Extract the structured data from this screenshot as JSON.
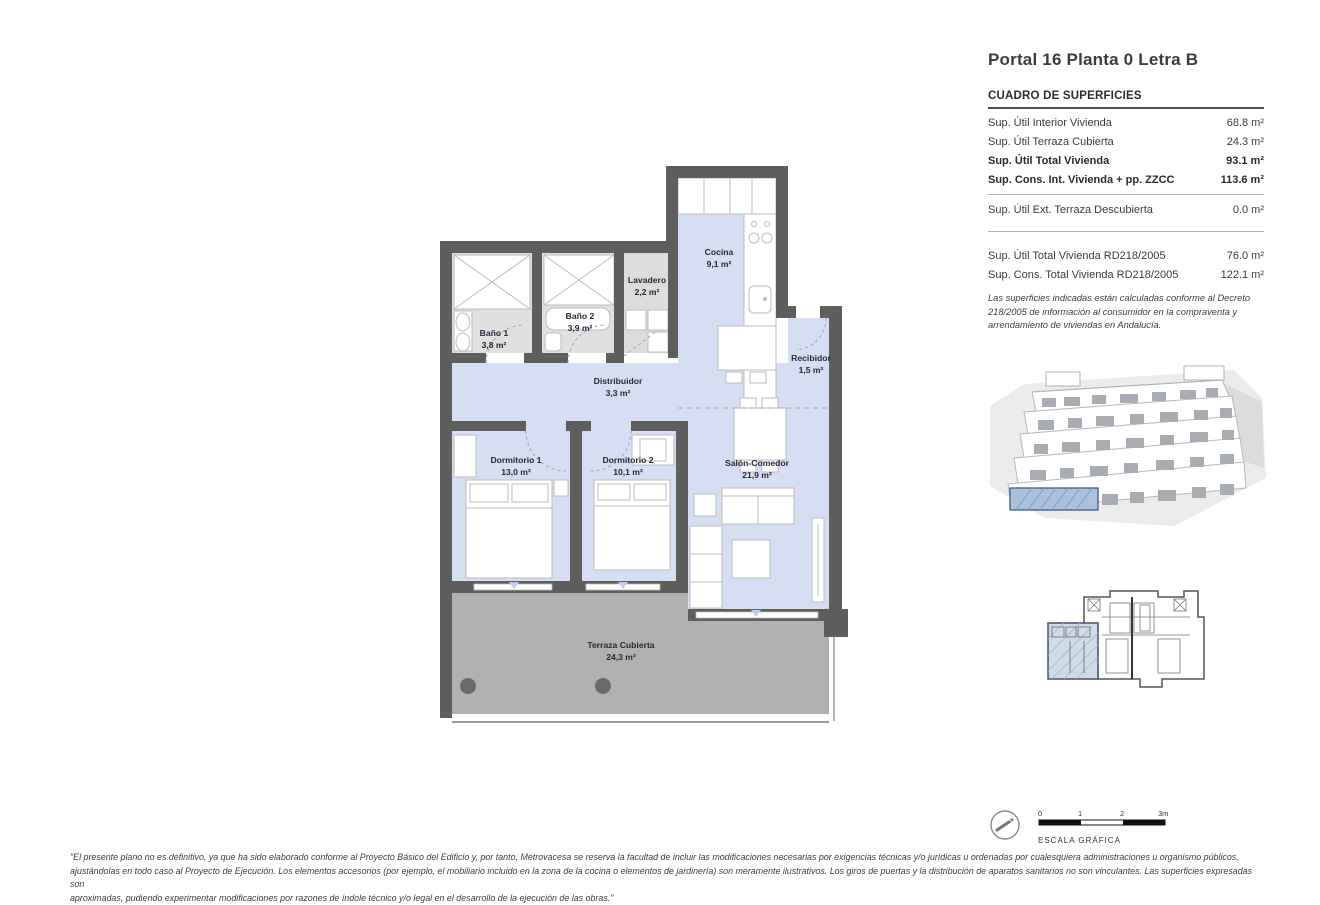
{
  "title": "Portal 16 Planta 0 Letra B",
  "surfaces": {
    "header": "CUADRO DE SUPERFICIES",
    "rows": [
      {
        "label": "Sup. Útil Interior Vivienda",
        "value": "68.8 m²"
      },
      {
        "label": "Sup. Útil Terraza Cubierta",
        "value": "24.3 m²"
      },
      {
        "label": "Sup. Útil Total Vivienda",
        "value": "93.1 m²"
      },
      {
        "label": "Sup. Cons. Int. Vivienda + pp. ZZCC",
        "value": "113.6 m²"
      },
      {
        "label": "Sup. Útil Ext. Terraza Descubierta",
        "value": "0.0 m²"
      },
      {
        "label": "Sup. Útil Total Vivienda RD218/2005",
        "value": "76.0 m²"
      },
      {
        "label": "Sup. Cons. Total Vivienda RD218/2005",
        "value": "122.1 m²"
      }
    ],
    "note": "Las superficies indicadas están calculadas conforme al Decreto 218/2005 de información al consumidor en la compraventa y arrendamiento de viviendas en Andalucía."
  },
  "rooms": {
    "cocina": {
      "name": "Cocina",
      "area": "9,1 m²"
    },
    "lavadero": {
      "name": "Lavadero",
      "area": "2,2 m²"
    },
    "bano1": {
      "name": "Baño 1",
      "area": "3,8 m²"
    },
    "bano2": {
      "name": "Baño 2",
      "area": "3,9 m²"
    },
    "recibidor": {
      "name": "Recibidor",
      "area": "1,5 m²"
    },
    "distribuidor": {
      "name": "Distribuidor",
      "area": "3,3 m²"
    },
    "dormitorio1": {
      "name": "Dormitorio 1",
      "area": "13,0 m²"
    },
    "dormitorio2": {
      "name": "Dormitorio 2",
      "area": "10,1 m²"
    },
    "salon": {
      "name": "Salón-Comedor",
      "area": "21,9 m²"
    },
    "terraza": {
      "name": "Terraza Cubierta",
      "area": "24,3 m²"
    }
  },
  "scale": {
    "label": "ESCALA GRÁFICA",
    "ticks": [
      "0",
      "1",
      "2",
      "3m"
    ]
  },
  "disclaimer": {
    "line1": "\"El presente plano no es definitivo, ya que ha sido elaborado conforme al Proyecto Básico del Edificio y, por tanto, Metrovacesa se reserva la facultad de incluir las modificaciones necesarias por exigencias técnicas y/o jurídicas u ordenadas por cualesquiera administraciones u organismo públicos,",
    "line2": "ajustándolas en todo caso al Proyecto de Ejecución. Los elementos accesorios (por ejemplo, el mobiliario incluido en la zona de la cocina o elementos de jardinería) son meramente ilustrativos. Los giros de puertas y la distribución de aparatos sanitarios no son vinculantes. Las superficies expresadas son",
    "line3": "aproximadas, pudiendo experimentar modificaciones por razones de índole técnico y/o legal en el desarrollo de la ejecución de las obras.\""
  },
  "colors": {
    "wall": "#5e5e5e",
    "room_blue": "#d6def4",
    "bath_gray": "#e0e0e0",
    "terrace_gray": "#b1b1b1",
    "highlight_blue": "#aac2de"
  }
}
